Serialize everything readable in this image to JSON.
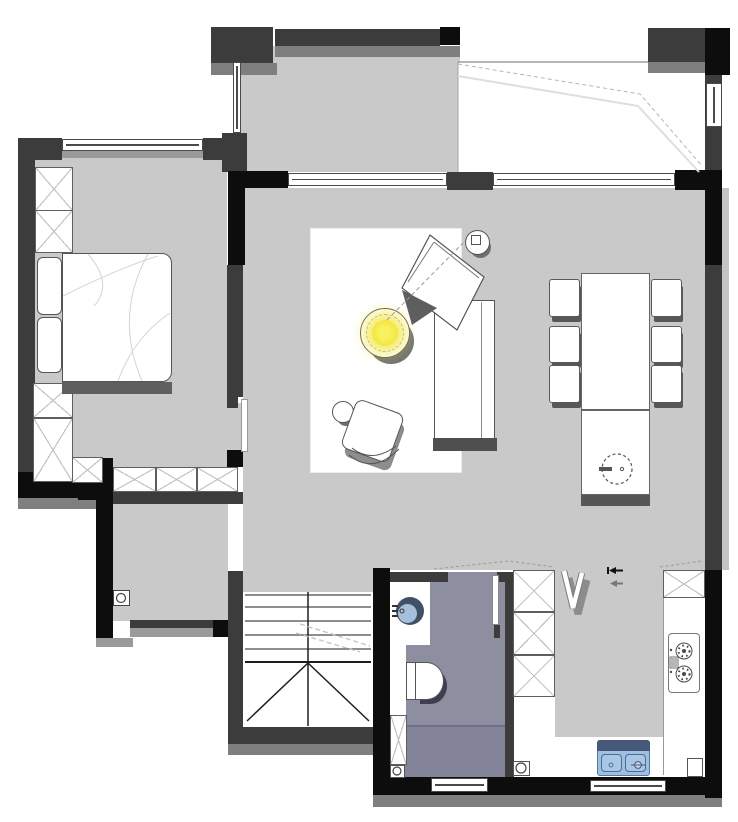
{
  "palette": {
    "wall_dark": "#3c3c3c",
    "wall_black": "#0d0d0d",
    "wall_shadow": "#7f7f7f",
    "floor_gray": "#c9c9c9",
    "bath_floor": "#8e8ea1",
    "lamp_yellow": "#f2e63c",
    "basin_navy": "#3f5166",
    "basin_blue": "#a6c0dc",
    "sink_blue": "#9fbfe0",
    "sink_navy": "#47597a",
    "line": "#555555"
  },
  "rooms": {
    "bedroom": "Bedroom",
    "multipurpose": "Multipurpose room",
    "balcony": "Balcony",
    "living": "Living room",
    "dining": "Dining area",
    "hall": "Entry hall",
    "stairs": "Staircase",
    "bathroom": "Bathroom",
    "kitchen": "Kitchen"
  },
  "fixtures": {
    "bed": "Double bed with pillows",
    "wardrobe": "Wardrobe cabinet",
    "closet": "Hall closet",
    "rug": "Area rug",
    "sofa": "Sofa with chaise",
    "armchair": "Armchair",
    "coffee_table": "Round coffee table with lamp",
    "side_table": "Round side table",
    "stool": "Round stool",
    "dining_table": "Dining table",
    "dining_chair": "Dining chair",
    "island": "Island cabinet with round basin",
    "stove": "Two-burner gas cooktop",
    "kitchen_sink": "Double-bowl kitchen sink",
    "counter": "Kitchen counter",
    "toilet": "Toilet",
    "wash_basin": "Round wash basin",
    "vanity": "Bathroom vanity",
    "shower": "Shower zone",
    "stair": "Staircase with treads",
    "entry_door": "Entry door marker",
    "door": "Door leaf",
    "window": "Window",
    "drain": "Floor drain",
    "duct": "Service duct",
    "v_symbol": "Folding-door symbol",
    "arrows": "Direction arrows"
  }
}
